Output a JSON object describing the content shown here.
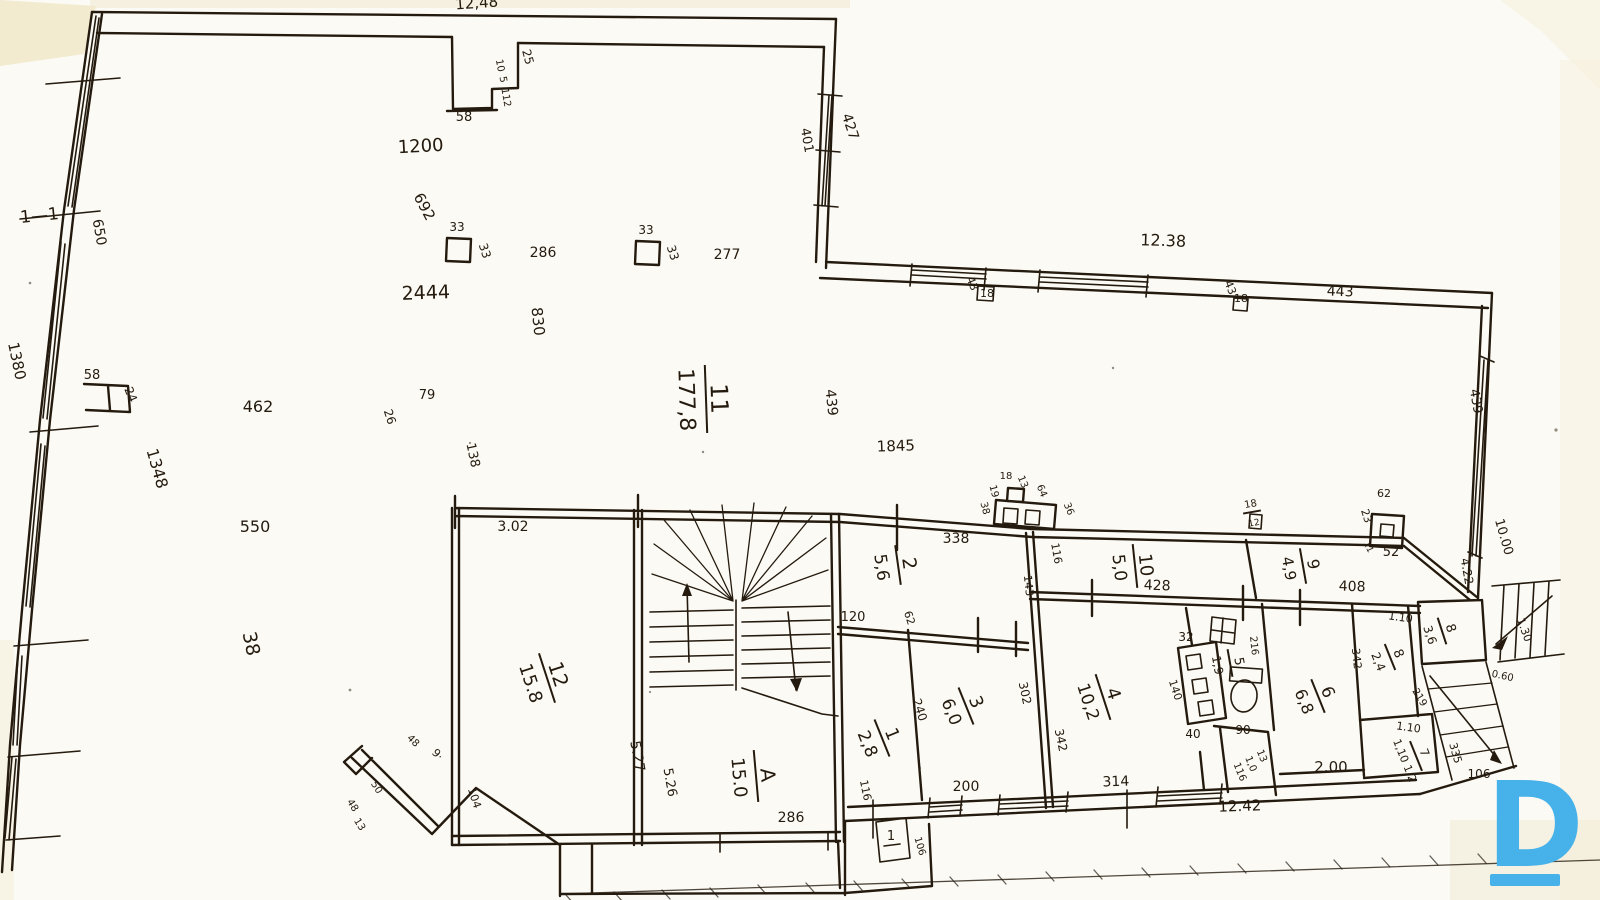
{
  "page": {
    "ink": "#241a0e",
    "paper": "#fbfaf5",
    "tint": "#efe6c2"
  },
  "logo": {
    "letter": "D",
    "color": "#47b1e9"
  },
  "markers": {
    "section_top": "1—1",
    "section_bottom": "1"
  },
  "rooms": [
    {
      "n": "11",
      "a": "177,8",
      "x": 706,
      "y": 399,
      "r": 88,
      "s": 24,
      "w": 34
    },
    {
      "n": "12",
      "a": "15.8",
      "x": 547,
      "y": 678,
      "r": 72,
      "s": 20,
      "w": 26
    },
    {
      "n": "A",
      "a": "15.0",
      "x": 756,
      "y": 776,
      "r": 85,
      "s": 20,
      "w": 26
    },
    {
      "n": "2",
      "a": "5,6",
      "x": 898,
      "y": 565,
      "r": 82,
      "s": 19,
      "w": 20
    },
    {
      "n": "1",
      "a": "2,8",
      "x": 882,
      "y": 738,
      "r": 68,
      "s": 18,
      "w": 20
    },
    {
      "n": "3",
      "a": "6,0",
      "x": 966,
      "y": 706,
      "r": 68,
      "s": 18,
      "w": 20
    },
    {
      "n": "4",
      "a": "10,2",
      "x": 1103,
      "y": 697,
      "r": 72,
      "s": 18,
      "w": 24
    },
    {
      "n": "10",
      "a": "5,0",
      "x": 1135,
      "y": 566,
      "r": 84,
      "s": 18,
      "w": 22
    },
    {
      "n": "9",
      "a": "4,9",
      "x": 1303,
      "y": 566,
      "r": 80,
      "s": 16,
      "w": 18
    },
    {
      "n": "5",
      "a": "1,9",
      "x": 1230,
      "y": 663,
      "r": 80,
      "s": 13,
      "w": 14
    },
    {
      "n": "6",
      "a": "6,8",
      "x": 1318,
      "y": 696,
      "r": 68,
      "s": 17,
      "w": 18
    },
    {
      "n": "8",
      "a": "2,4",
      "x": 1390,
      "y": 657,
      "r": 68,
      "s": 13,
      "w": 14
    },
    {
      "n": "8",
      "a": "3,6",
      "x": 1442,
      "y": 631,
      "r": 72,
      "s": 13,
      "w": 14
    },
    {
      "n": "18",
      "a": "12",
      "x": 1252,
      "y": 512,
      "r": -10,
      "s": 10,
      "w": 9
    },
    {
      "n": "7",
      "a": "1,10 1,2",
      "x": 1416,
      "y": 756,
      "r": 68,
      "s": 12,
      "w": 16
    }
  ],
  "dims": [
    {
      "t": "12,48",
      "x": 477,
      "y": 8,
      "r": -4,
      "s": 15
    },
    {
      "t": "25",
      "x": 524,
      "y": 58,
      "r": 75,
      "s": 12
    },
    {
      "t": "10",
      "x": 497,
      "y": 66,
      "r": 80,
      "s": 10
    },
    {
      "t": "5",
      "x": 500,
      "y": 80,
      "r": 80,
      "s": 10
    },
    {
      "t": "112",
      "x": 503,
      "y": 98,
      "r": 80,
      "s": 10
    },
    {
      "t": "58",
      "x": 464,
      "y": 121,
      "r": 0,
      "s": 13
    },
    {
      "t": "1200",
      "x": 421,
      "y": 152,
      "r": -3,
      "s": 18
    },
    {
      "t": "692",
      "x": 420,
      "y": 209,
      "r": 62,
      "s": 15
    },
    {
      "t": "33",
      "x": 457,
      "y": 231,
      "r": 0,
      "s": 12
    },
    {
      "t": "33",
      "x": 481,
      "y": 252,
      "r": 72,
      "s": 12
    },
    {
      "t": "286",
      "x": 543,
      "y": 257,
      "r": 0,
      "s": 14
    },
    {
      "t": "33",
      "x": 646,
      "y": 234,
      "r": 0,
      "s": 12
    },
    {
      "t": "33",
      "x": 669,
      "y": 254,
      "r": 72,
      "s": 12
    },
    {
      "t": "277",
      "x": 727,
      "y": 259,
      "r": 0,
      "s": 14
    },
    {
      "t": "2444",
      "x": 426,
      "y": 299,
      "r": -2,
      "s": 19
    },
    {
      "t": "830",
      "x": 533,
      "y": 322,
      "r": 84,
      "s": 15
    },
    {
      "t": "401",
      "x": 803,
      "y": 141,
      "r": 80,
      "s": 13
    },
    {
      "t": "427",
      "x": 846,
      "y": 128,
      "r": 72,
      "s": 14
    },
    {
      "t": "12.38",
      "x": 1163,
      "y": 246,
      "r": 2,
      "s": 16
    },
    {
      "t": "43",
      "x": 969,
      "y": 285,
      "r": 68,
      "s": 11
    },
    {
      "t": "18",
      "x": 987,
      "y": 297,
      "r": 0,
      "s": 11
    },
    {
      "t": "43",
      "x": 1227,
      "y": 289,
      "r": 68,
      "s": 11
    },
    {
      "t": "18",
      "x": 1241,
      "y": 302,
      "r": 0,
      "s": 11
    },
    {
      "t": "443",
      "x": 1340,
      "y": 296,
      "r": 2,
      "s": 14
    },
    {
      "t": "650",
      "x": 95,
      "y": 233,
      "r": 80,
      "s": 14
    },
    {
      "t": "1380",
      "x": 12,
      "y": 362,
      "r": 78,
      "s": 15
    },
    {
      "t": "58",
      "x": 92,
      "y": 379,
      "r": 0,
      "s": 13
    },
    {
      "t": "24",
      "x": 127,
      "y": 396,
      "r": 68,
      "s": 12
    },
    {
      "t": "462",
      "x": 258,
      "y": 412,
      "r": 0,
      "s": 16
    },
    {
      "t": "1348",
      "x": 152,
      "y": 470,
      "r": 74,
      "s": 16
    },
    {
      "t": "550",
      "x": 255,
      "y": 532,
      "r": 0,
      "s": 16
    },
    {
      "t": "38",
      "x": 245,
      "y": 645,
      "r": 78,
      "s": 19
    },
    {
      "t": "79",
      "x": 427,
      "y": 399,
      "r": 0,
      "s": 13
    },
    {
      "t": "26",
      "x": 386,
      "y": 418,
      "r": 72,
      "s": 12
    },
    {
      "t": "138",
      "x": 469,
      "y": 456,
      "r": 78,
      "s": 13
    },
    {
      "t": "3.02",
      "x": 513,
      "y": 531,
      "r": 0,
      "s": 14
    },
    {
      "t": "439",
      "x": 827,
      "y": 403,
      "r": 84,
      "s": 14
    },
    {
      "t": "1845",
      "x": 896,
      "y": 451,
      "r": -2,
      "s": 15
    },
    {
      "t": "18",
      "x": 1006,
      "y": 479,
      "r": 0,
      "s": 10
    },
    {
      "t": "13",
      "x": 1020,
      "y": 483,
      "r": 68,
      "s": 10
    },
    {
      "t": "19",
      "x": 991,
      "y": 492,
      "r": 75,
      "s": 10
    },
    {
      "t": "38",
      "x": 982,
      "y": 509,
      "r": 75,
      "s": 10
    },
    {
      "t": "64",
      "x": 1039,
      "y": 492,
      "r": 68,
      "s": 10
    },
    {
      "t": "36",
      "x": 1066,
      "y": 510,
      "r": 68,
      "s": 10
    },
    {
      "t": "338",
      "x": 956,
      "y": 543,
      "r": 0,
      "s": 14
    },
    {
      "t": "116",
      "x": 1053,
      "y": 554,
      "r": 80,
      "s": 11
    },
    {
      "t": "143",
      "x": 1025,
      "y": 586,
      "r": 84,
      "s": 11
    },
    {
      "t": "120",
      "x": 853,
      "y": 621,
      "r": 0,
      "s": 13
    },
    {
      "t": "62",
      "x": 906,
      "y": 619,
      "r": 72,
      "s": 11
    },
    {
      "t": "428",
      "x": 1157,
      "y": 590,
      "r": 2,
      "s": 14
    },
    {
      "t": "62",
      "x": 1384,
      "y": 497,
      "r": 0,
      "s": 11
    },
    {
      "t": "23",
      "x": 1363,
      "y": 517,
      "r": 72,
      "s": 11
    },
    {
      "t": "52",
      "x": 1391,
      "y": 556,
      "r": 0,
      "s": 13
    },
    {
      "t": "11",
      "x": 1366,
      "y": 548,
      "r": 65,
      "s": 9
    },
    {
      "t": "408",
      "x": 1352,
      "y": 591,
      "r": 2,
      "s": 14
    },
    {
      "t": "4.22",
      "x": 1463,
      "y": 572,
      "r": 80,
      "s": 12
    },
    {
      "t": "439",
      "x": 1472,
      "y": 402,
      "r": 80,
      "s": 13
    },
    {
      "t": "10.00",
      "x": 1500,
      "y": 538,
      "r": 74,
      "s": 13
    },
    {
      "t": "5.27",
      "x": 633,
      "y": 757,
      "r": 80,
      "s": 14
    },
    {
      "t": "5.26",
      "x": 666,
      "y": 783,
      "r": 80,
      "s": 13
    },
    {
      "t": "286",
      "x": 791,
      "y": 822,
      "r": 0,
      "s": 14
    },
    {
      "t": "240",
      "x": 916,
      "y": 711,
      "r": 72,
      "s": 12
    },
    {
      "t": "302",
      "x": 1021,
      "y": 694,
      "r": 78,
      "s": 12
    },
    {
      "t": "200",
      "x": 966,
      "y": 791,
      "r": 0,
      "s": 14
    },
    {
      "t": "116",
      "x": 862,
      "y": 791,
      "r": 78,
      "s": 11
    },
    {
      "t": "342",
      "x": 1057,
      "y": 741,
      "r": 78,
      "s": 12
    },
    {
      "t": "314",
      "x": 1116,
      "y": 786,
      "r": -2,
      "s": 14
    },
    {
      "t": "140",
      "x": 1172,
      "y": 691,
      "r": 72,
      "s": 11
    },
    {
      "t": "40",
      "x": 1193,
      "y": 738,
      "r": 0,
      "s": 12
    },
    {
      "t": "32",
      "x": 1186,
      "y": 641,
      "r": 0,
      "s": 12
    },
    {
      "t": "216",
      "x": 1251,
      "y": 646,
      "r": 84,
      "s": 10
    },
    {
      "t": "90",
      "x": 1243,
      "y": 734,
      "r": 0,
      "s": 12
    },
    {
      "t": "13",
      "x": 1259,
      "y": 757,
      "r": 68,
      "s": 10
    },
    {
      "t": "1,0",
      "x": 1248,
      "y": 765,
      "r": 68,
      "s": 10
    },
    {
      "t": "116",
      "x": 1237,
      "y": 773,
      "r": 68,
      "s": 10
    },
    {
      "t": "342",
      "x": 1353,
      "y": 659,
      "r": 84,
      "s": 11
    },
    {
      "t": "2.00",
      "x": 1331,
      "y": 772,
      "r": 0,
      "s": 15
    },
    {
      "t": "1.10",
      "x": 1400,
      "y": 621,
      "r": 8,
      "s": 11
    },
    {
      "t": "1.10",
      "x": 1408,
      "y": 731,
      "r": 8,
      "s": 11
    },
    {
      "t": "219",
      "x": 1417,
      "y": 699,
      "r": 58,
      "s": 10
    },
    {
      "t": "335",
      "x": 1452,
      "y": 754,
      "r": 74,
      "s": 11
    },
    {
      "t": "106",
      "x": 1479,
      "y": 778,
      "r": 0,
      "s": 12
    },
    {
      "t": "1.30",
      "x": 1521,
      "y": 631,
      "r": 70,
      "s": 11
    },
    {
      "t": "0.60",
      "x": 1502,
      "y": 679,
      "r": 12,
      "s": 10
    },
    {
      "t": "12.42",
      "x": 1240,
      "y": 811,
      "r": -2,
      "s": 15
    },
    {
      "t": "106",
      "x": 917,
      "y": 847,
      "r": 74,
      "s": 10
    },
    {
      "t": "48",
      "x": 411,
      "y": 743,
      "r": 45,
      "s": 10
    },
    {
      "t": "9·",
      "x": 435,
      "y": 757,
      "r": 45,
      "s": 11
    },
    {
      "t": "104",
      "x": 471,
      "y": 799,
      "r": 72,
      "s": 11
    },
    {
      "t": "50",
      "x": 374,
      "y": 789,
      "r": 58,
      "s": 10
    },
    {
      "t": "48",
      "x": 350,
      "y": 807,
      "r": 58,
      "s": 10
    },
    {
      "t": "13",
      "x": 357,
      "y": 826,
      "r": 58,
      "s": 10
    }
  ]
}
